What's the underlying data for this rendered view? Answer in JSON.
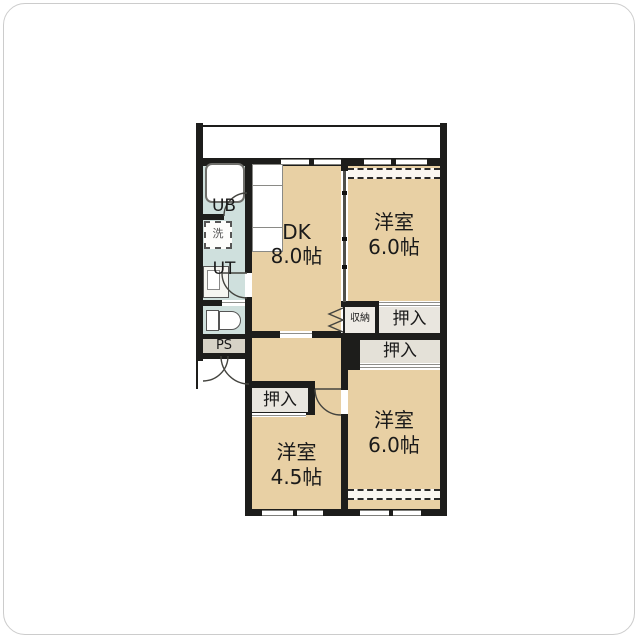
{
  "document": {
    "type": "apartment-floor-plan",
    "layout_name": "3DK"
  },
  "rooms": {
    "dk": {
      "name": "DK",
      "size": "8.0帖"
    },
    "bedroom_ne": {
      "name": "洋室",
      "size": "6.0帖"
    },
    "bedroom_se": {
      "name": "洋室",
      "size": "6.0帖"
    },
    "bedroom_sw": {
      "name": "洋室",
      "size": "4.5帖"
    }
  },
  "labels": {
    "unit_bath": "UB",
    "utility": "UT",
    "pipe_space": "PS",
    "laundry": "洗",
    "storage": "収納",
    "closet_ne": "押入",
    "closet_se": "押入",
    "closet_sw": "押入"
  },
  "colors": {
    "room_floor_tan": "#e8d0a4",
    "wet_area_blue": "#cfe0dd",
    "pipe_space_gray": "#d6d2c6",
    "closet_fill": "#e9e6df",
    "wall_black": "#1d1d1b",
    "window_gray": "#7e7e7a",
    "background": "#ffffff"
  }
}
